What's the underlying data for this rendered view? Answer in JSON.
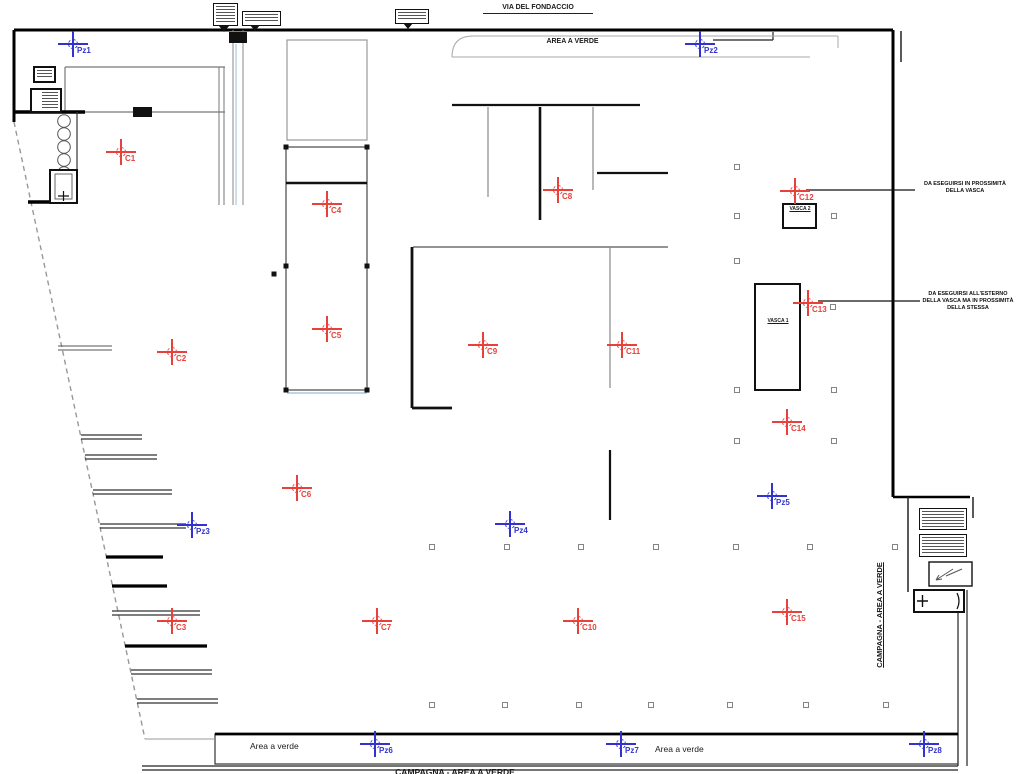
{
  "drawing": {
    "road_label": "VIA DEL FONDACCIO",
    "top_green_label": "AREA A VERDE",
    "bottom_green_left_label": "Area a verde",
    "bottom_green_right_label": "Area a verde",
    "bottom_boundary_label": "CAMPAGNA - AREA A VERDE",
    "right_boundary_label": "CAMPAGNA - AREA A VERDE",
    "vasca1_label": "VASCA 1",
    "vasca2_label": "VASCA 2",
    "note_vasca2": {
      "line1": "DA ESEGUIRSI IN PROSSIMITÀ",
      "line2": "DELLA VASCA"
    },
    "note_vasca1": {
      "line1": "DA ESEGUIRSI ALL'ESTERNO",
      "line2": "DELLA VASCA MA IN PROSSIMITÀ",
      "line3": "DELLA STESSA"
    }
  },
  "colors": {
    "red_marker": "#e8403a",
    "blue_marker": "#3232cf",
    "wall": "#000000",
    "thin_line": "#888888"
  },
  "sample_points": {
    "red_crosses": [
      {
        "label": "C1",
        "x": 121,
        "y": 152
      },
      {
        "label": "C2",
        "x": 172,
        "y": 352
      },
      {
        "label": "C3",
        "x": 172,
        "y": 621
      },
      {
        "label": "C4",
        "x": 327,
        "y": 204
      },
      {
        "label": "C5",
        "x": 327,
        "y": 329
      },
      {
        "label": "C6",
        "x": 297,
        "y": 488
      },
      {
        "label": "C7",
        "x": 377,
        "y": 621
      },
      {
        "label": "C8",
        "x": 558,
        "y": 190
      },
      {
        "label": "C9",
        "x": 483,
        "y": 345
      },
      {
        "label": "C10",
        "x": 578,
        "y": 621
      },
      {
        "label": "C11",
        "x": 622,
        "y": 345
      },
      {
        "label": "C12",
        "x": 795,
        "y": 191
      },
      {
        "label": "C13",
        "x": 808,
        "y": 303
      },
      {
        "label": "C14",
        "x": 787,
        "y": 422
      },
      {
        "label": "C15",
        "x": 787,
        "y": 612
      }
    ],
    "blue_crosses": [
      {
        "label": "Pz1",
        "x": 73,
        "y": 44
      },
      {
        "label": "Pz2",
        "x": 700,
        "y": 44
      },
      {
        "label": "Pz3",
        "x": 192,
        "y": 525
      },
      {
        "label": "Pz4",
        "x": 510,
        "y": 524
      },
      {
        "label": "Pz5",
        "x": 772,
        "y": 496
      },
      {
        "label": "Pz6",
        "x": 375,
        "y": 744
      },
      {
        "label": "Pz7",
        "x": 621,
        "y": 744
      },
      {
        "label": "Pz8",
        "x": 924,
        "y": 744
      }
    ]
  }
}
